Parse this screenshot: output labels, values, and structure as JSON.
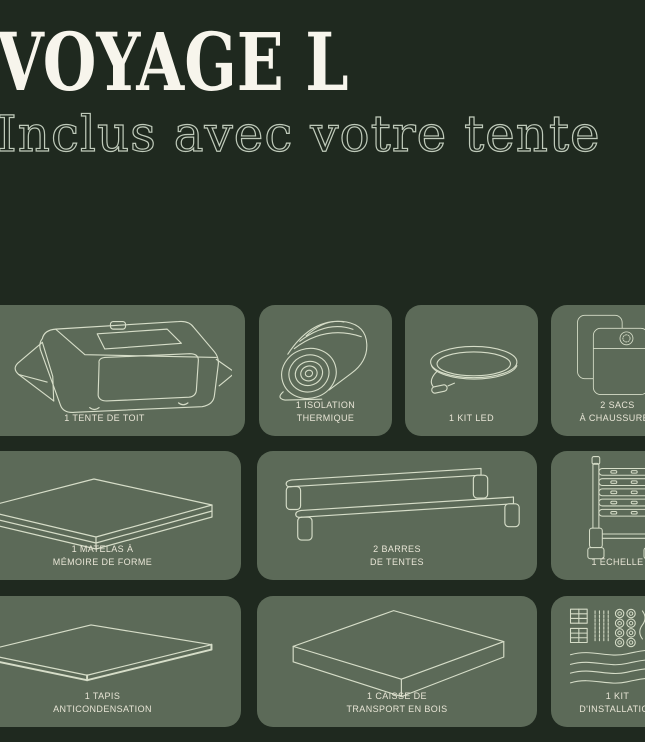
{
  "page": {
    "title": "VOYAGE L",
    "subtitle": "Inclus avec votre tente"
  },
  "colors": {
    "background": "#1f291f",
    "card": "#5c6a58",
    "card_label": "#e8e5d6",
    "illustration": "#d6ddc8",
    "title": "#f7f5ec",
    "subtitle_outline": "#bfcaba"
  },
  "cards": [
    {
      "name": "roof-tent",
      "label_lines": [
        "1 TENTE DE TOIT"
      ]
    },
    {
      "name": "thermal-insulation",
      "label_lines": [
        "1 ISOLATION",
        "THERMIQUE"
      ]
    },
    {
      "name": "led-kit",
      "label_lines": [
        "1 KIT LED"
      ]
    },
    {
      "name": "shoe-bags",
      "label_lines": [
        "2 SACS",
        "À CHAUSSURES"
      ]
    },
    {
      "name": "memory-foam-mattress",
      "label_lines": [
        "1 MATELAS À",
        "MÉMOIRE DE FORME"
      ]
    },
    {
      "name": "tent-bars",
      "label_lines": [
        "2 BARRES",
        "DE TENTES"
      ]
    },
    {
      "name": "ladder",
      "label_lines": [
        "1 ÉCHELLE"
      ]
    },
    {
      "name": "anticondensation-mat",
      "label_lines": [
        "1 TAPIS",
        "ANTICONDENSATION"
      ]
    },
    {
      "name": "wooden-transport-box",
      "label_lines": [
        "1 CAISSE DE",
        "TRANSPORT EN BOIS"
      ]
    },
    {
      "name": "installation-kit",
      "label_lines": [
        "1 KIT",
        "D'INSTALLATION"
      ]
    }
  ]
}
